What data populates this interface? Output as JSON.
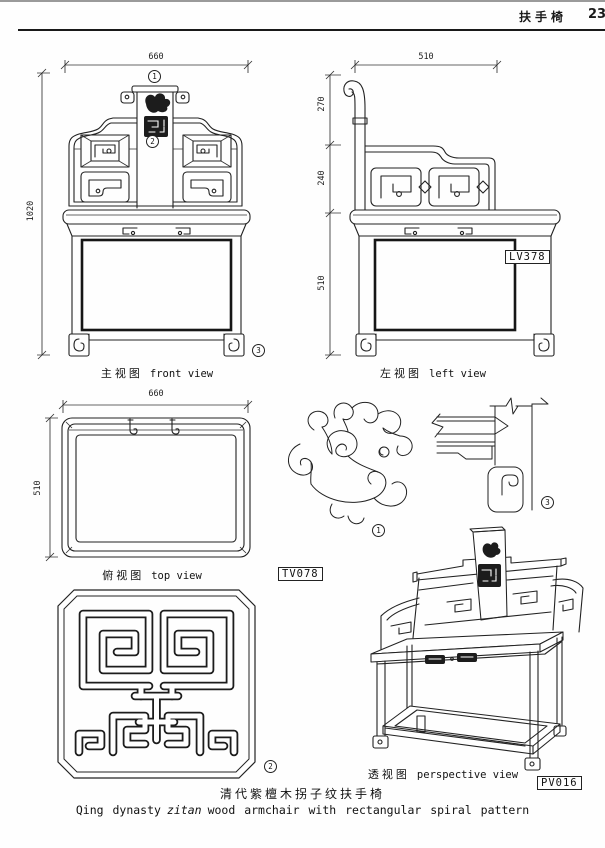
{
  "header": {
    "title": "扶手椅",
    "page_number": "23"
  },
  "front_view": {
    "caption_cn": "主视图",
    "caption_en": "front view",
    "dim_width": "660",
    "dim_height": "1020",
    "marker_crest": "1",
    "marker_splat": "2",
    "marker_leg": "3"
  },
  "left_view": {
    "caption_cn": "左视图",
    "caption_en": "left view",
    "dim_width": "510",
    "dim_back_top": "270",
    "dim_back_mid": "240",
    "dim_seat": "510",
    "code": "LV378"
  },
  "top_view": {
    "caption_cn": "俯视图",
    "caption_en": "top view",
    "dim_width": "660",
    "dim_depth": "510",
    "code": "TV078"
  },
  "details": {
    "cloud_carving_marker": "1",
    "splat_panel_marker": "2",
    "leg_joint_marker": "3"
  },
  "perspective_view": {
    "caption_cn": "透视图",
    "caption_en": "perspective view",
    "code": "PV016"
  },
  "footer": {
    "caption_cn": "清代紫檀木拐子纹扶手椅",
    "caption_en_pre": "Qing dynasty",
    "caption_en_italic": "zitan",
    "caption_en_post": "wood armchair with rectangular spiral pattern"
  }
}
